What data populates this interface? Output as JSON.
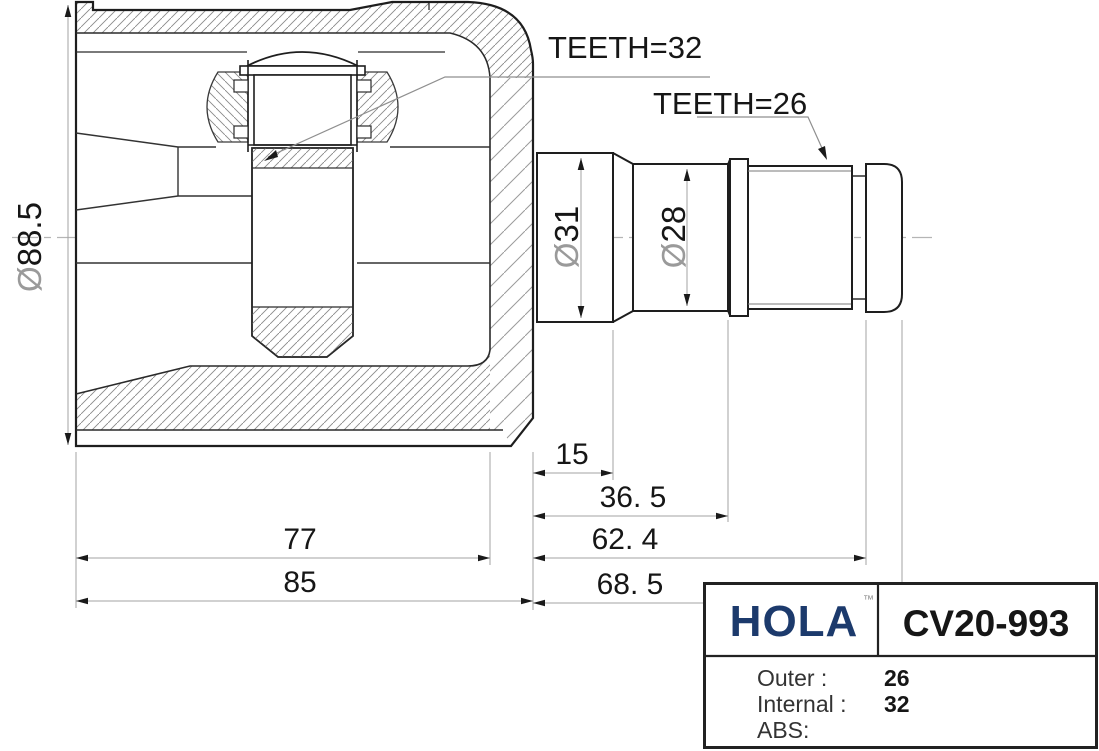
{
  "drawing": {
    "labels": {
      "teeth_inner": "TEETH=32",
      "teeth_shaft": "TEETH=26"
    },
    "dims": {
      "d15": "15",
      "d36_5": "36. 5",
      "d62_4": "62. 4",
      "d68_5": "68. 5",
      "d77": "77",
      "d85": "85"
    },
    "dia_housing": {
      "symbol": "Ø",
      "value": "88.5"
    },
    "dia_31": {
      "symbol": "Ø",
      "value": "31"
    },
    "dia_28": {
      "symbol": "Ø",
      "value": "28"
    }
  },
  "title_block": {
    "brand": "HOLA",
    "brand_tm": "™",
    "part_number": "CV20-993",
    "rows": [
      {
        "label": "Outer :",
        "value": "26"
      },
      {
        "label": "Internal :",
        "value": "32"
      },
      {
        "label": "ABS:",
        "value": ""
      }
    ]
  },
  "colors": {
    "brand_navy": "#1c3a6c",
    "line_dark": "#1e1e1e",
    "dim_gray": "#a3a3a3"
  }
}
